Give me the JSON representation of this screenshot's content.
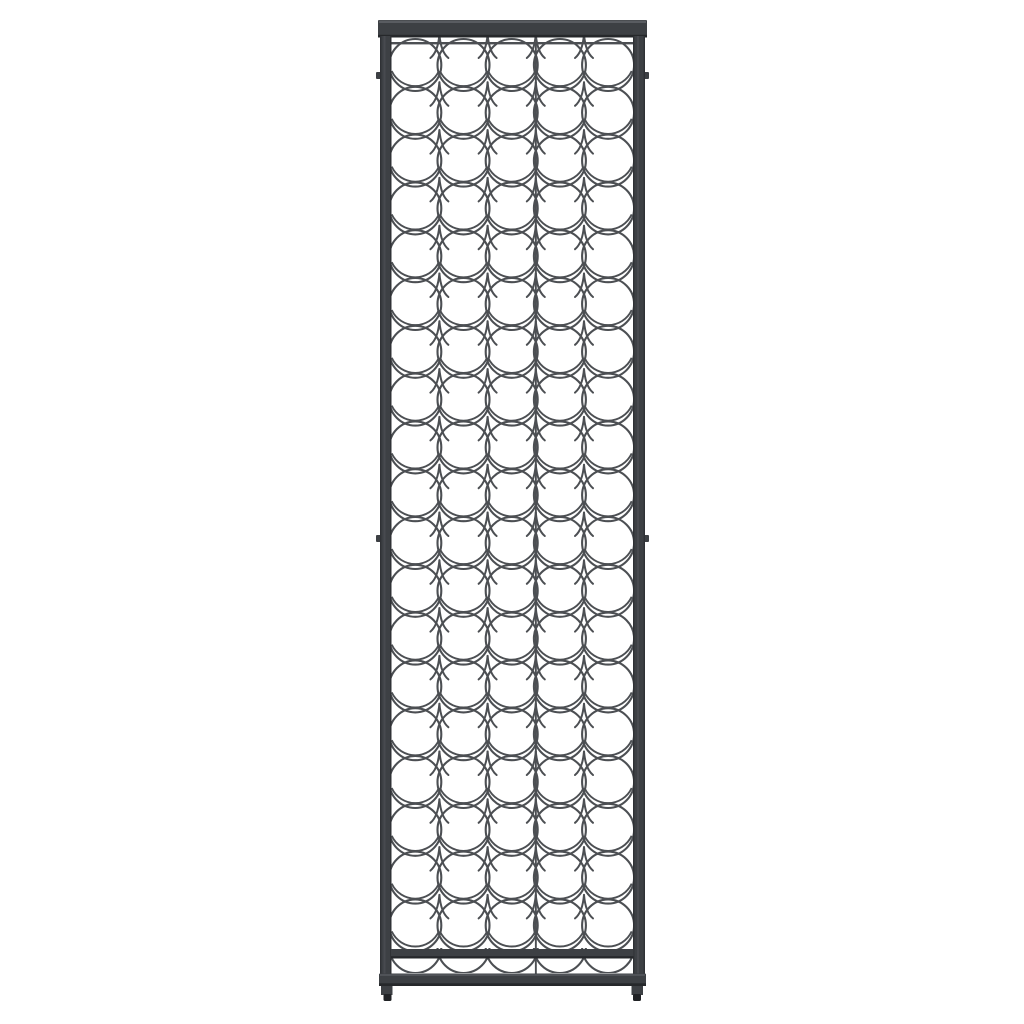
{
  "scene": {
    "kind": "product-photo",
    "subject": "Tall narrow black wrought-iron wine bottle rack, front view, centered on a plain white background",
    "colors": {
      "background": "#ffffff",
      "frame": "#3d4044",
      "frame_highlight": "#63666b",
      "frame_shadow": "#26282b",
      "wire": "#4c4f53",
      "feet": "#202225"
    }
  },
  "rack": {
    "columns": 5,
    "full_ring_rows": 19,
    "full_rings": 95,
    "bottom_partial_arcs": 5,
    "center_divider_wires": 1,
    "wall_mount_tabs": 4,
    "legs": 2,
    "feet": 2
  }
}
